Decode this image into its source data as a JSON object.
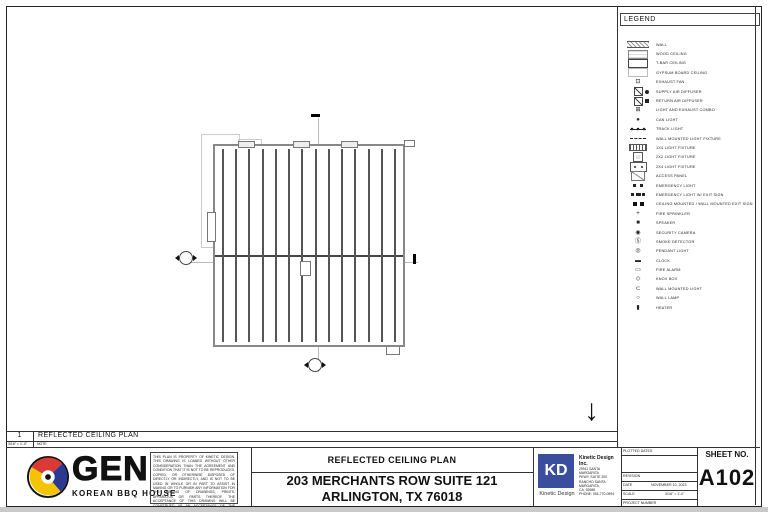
{
  "colors": {
    "kd_blue": "#3b4e9e",
    "gen_red": "#d93a35",
    "gen_blue": "#2b3990",
    "gen_yellow": "#f5c400"
  },
  "legend": {
    "title": "LEGEND",
    "items": [
      {
        "label": "WALL",
        "icon": "wall-icon",
        "cls": "i-wall"
      },
      {
        "label": "WOOD CEILING",
        "icon": "wood-ceiling-icon",
        "cls": "i-wood"
      },
      {
        "label": "T-BAR CEILING",
        "icon": "tbar-ceiling-icon",
        "cls": "i-tbar"
      },
      {
        "label": "GYPSUM BOARD CEILING",
        "icon": "gypsum-board-ceiling-icon",
        "cls": "i-gyp"
      },
      {
        "label": "EXHAUST FAN",
        "icon": "exhaust-fan-icon",
        "glyph": "⊡"
      },
      {
        "label": "SUPPLY AIR DIFFUSER",
        "icon": "supply-air-diffuser-icon",
        "cls": "i-supply"
      },
      {
        "label": "RETURN AIR DIFFUSER",
        "icon": "return-air-diffuser-icon",
        "cls": "i-return"
      },
      {
        "label": "LIGHT AND EXHAUST COMBO",
        "icon": "light-exhaust-combo-icon",
        "glyph": "⊞"
      },
      {
        "label": "CAN LIGHT",
        "icon": "can-light-icon",
        "glyph": "●"
      },
      {
        "label": "TRACK LIGHT",
        "icon": "track-light-icon",
        "cls": "i-track"
      },
      {
        "label": "WALL MOUNTED LIGHT FIXTURE",
        "icon": "wall-mounted-light-fixture-icon",
        "cls": "i-dash"
      },
      {
        "label": "1X4 LIGHT FIXTURE",
        "icon": "1x4-light-fixture-icon",
        "cls": "i-1x4"
      },
      {
        "label": "2X2 LIGHT FIXTURE",
        "icon": "2x2-light-fixture-icon",
        "cls": "i-2x2"
      },
      {
        "label": "2X4 LIGHT FIXTURE",
        "icon": "2x4-light-fixture-icon",
        "cls": "i-2x4"
      },
      {
        "label": "ACCESS PANEL",
        "icon": "access-panel-icon",
        "cls": "i-access"
      },
      {
        "label": "EMERGENCY LIGHT",
        "icon": "emergency-light-icon",
        "cls": "i-em"
      },
      {
        "label": "EMERGENCY LIGHT W/ EXIT SIGN",
        "icon": "emergency-light-exit-sign-icon",
        "cls": "i-emx"
      },
      {
        "label": "CEILING MOUNTED / WALL MOUNTED EXIT SIGN",
        "icon": "exit-sign-icon",
        "cls": "i-exit"
      },
      {
        "label": "FIRE SPRINKLER",
        "icon": "fire-sprinkler-icon",
        "glyph": "+"
      },
      {
        "label": "SPEAKER",
        "icon": "speaker-icon",
        "glyph": "■"
      },
      {
        "label": "SECURITY CAMERA",
        "icon": "security-camera-icon",
        "glyph": "◉"
      },
      {
        "label": "SMOKE DETECTOR",
        "icon": "smoke-detector-icon",
        "glyph": "Ⓢ"
      },
      {
        "label": "PENDANT LIGHT",
        "icon": "pendant-light-icon",
        "glyph": "◎"
      },
      {
        "label": "CLOCK",
        "icon": "clock-icon",
        "glyph": "▬"
      },
      {
        "label": "FIRE ALARM",
        "icon": "fire-alarm-icon",
        "glyph": "▭"
      },
      {
        "label": "KNOX BOX",
        "icon": "knox-box-icon",
        "glyph": "◇"
      },
      {
        "label": "WALL MOUNTED LIGHT",
        "icon": "wall-mounted-light-icon",
        "glyph": "⊂"
      },
      {
        "label": "WALL LAMP",
        "icon": "wall-lamp-icon",
        "glyph": "○"
      },
      {
        "label": "HEATER",
        "icon": "heater-icon",
        "glyph": "▮"
      }
    ]
  },
  "drawing": {
    "joist_count": 14,
    "north_arrow": "↓"
  },
  "title_strip": {
    "number": "1",
    "title": "REFLECTED CEILING PLAN",
    "scale": "3/16\" = 1'-0\"",
    "note": "NOTE"
  },
  "branding": {
    "logo_text": "GEN",
    "logo_sub": "KOREAN BBQ HOUSE"
  },
  "disclaimer": "THIS PLAN IS PROPERTY OF KINETIC DESIGN. THIS DRAWING IS LOANED WITHOUT OTHER CONSIDERATION THAN THE AGREEMENT AND CONDITION THAT IT IS NOT TO BE REPRODUCED, COPIED, OR OTHERWISE DISPOSED OF DIRECTLY OR INDIRECTLY, AND IS NOT TO BE USED IN WHOLE OR IN PART TO ASSIST IN MAKING OR TO FURNISH ANY INFORMATION FOR THE MAKING OF DRAWINGS, PRINTS, APPARATUS OR PARTS THEREOF. THE ACCEPTANCE OF THIS DRAWING WILL BE CONSTRUED AS AN ACCEPTANCE OF THE FOREGOING CONDITIONS.",
  "project": {
    "drawing_title": "REFLECTED CEILING PLAN",
    "address_line1": "203 MERCHANTS ROW SUITE 121",
    "address_line2": "ARLINGTON, TX 76018"
  },
  "firm": {
    "logo": "KD",
    "logo_caption": "Kinetic Design",
    "name": "Kinetic Design Inc.",
    "address_line1": "29911 SANTA MARGARITA",
    "address_line2": "PKWY, SUITE 200",
    "address_line3": "RANCHO SANTA MARGARITA,",
    "address_line4": "CA, 92688",
    "phone": "PHONE: 951-770-0594"
  },
  "fields": {
    "plotted_label": "PLOTTED DATES",
    "revision_label": "REVISION",
    "date_label": "DATE",
    "date_value": "NOVEMBER 10, 2023",
    "scale_label": "SCALE",
    "scale_value": "3/16\" = 1'-0\"",
    "project_number_label": "PROJECT NUMBER"
  },
  "sheet_no": {
    "label": "SHEET NO.",
    "value": "A102"
  }
}
